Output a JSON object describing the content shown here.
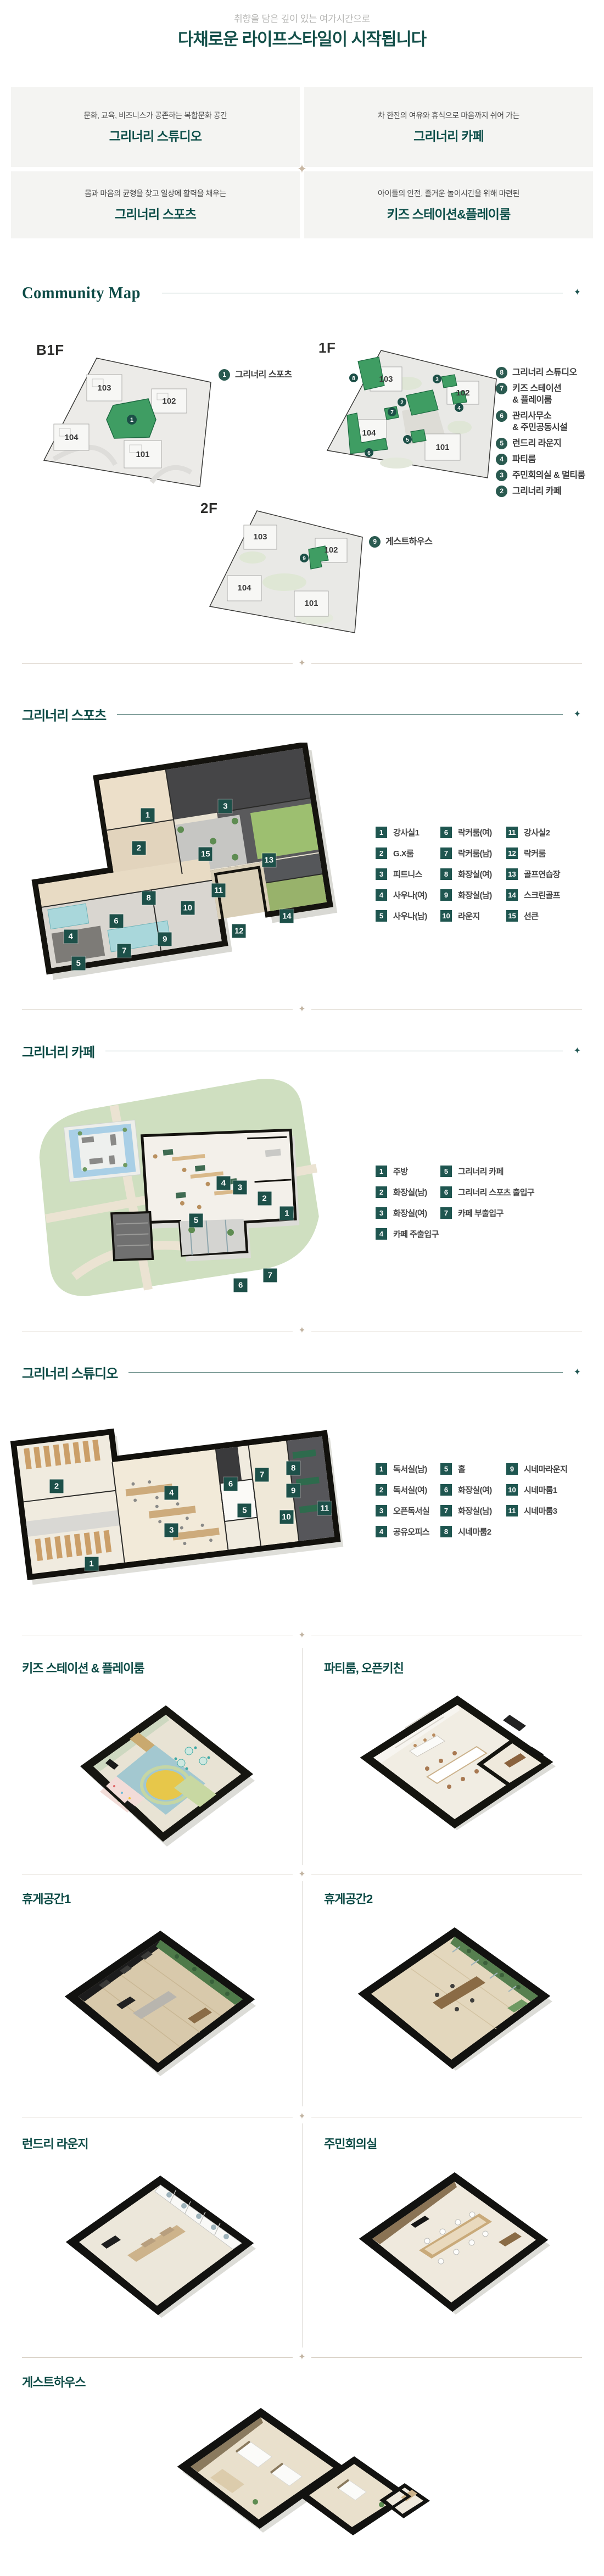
{
  "icons": {
    "diamond": "✦"
  },
  "colors": {
    "accent_teal": "#0d4b46",
    "legend_box": "#1f5650",
    "map_marker": "#2a5a50",
    "highlight_green": "#3f9d63",
    "divider_beige": "#cfc5b8",
    "card_bg": "#f4f4f2"
  },
  "header": {
    "subtitle": "취향을 담은 깊이 있는 여가시간으로",
    "title": "다채로운 라이프스타일이 시작됩니다"
  },
  "feature_cards": [
    {
      "desc": "문화, 교육, 비즈니스가 공존하는 복합문화 공간",
      "title": "그리너리 스튜디오"
    },
    {
      "desc": "차 한잔의 여유와 휴식으로 마음까지 쉬어 가는",
      "title": "그리너리 카페"
    },
    {
      "desc": "몸과 마음의 균형을 찾고 일상에 활력을 채우는",
      "title": "그리너리 스포츠"
    },
    {
      "desc": "아이들의 안전, 즐거운 놀이시간을 위해 마련된",
      "title": "키즈 스테이션&플레이룸"
    }
  ],
  "community_map": {
    "title": "Community Map",
    "floors": [
      {
        "label": "B1F",
        "buildings": [
          "103",
          "102",
          "104",
          "101"
        ],
        "legend": [
          {
            "num": "1",
            "label": "그리너리 스포츠"
          }
        ]
      },
      {
        "label": "1F",
        "buildings": [
          "103",
          "102",
          "104",
          "101"
        ],
        "legend": [
          {
            "num": "8",
            "label": "그리너리 스튜디오"
          },
          {
            "num": "7",
            "label": "키즈 스테이션\n& 플레이룸"
          },
          {
            "num": "6",
            "label": "관리사무소\n& 주민공동시설"
          },
          {
            "num": "5",
            "label": "런드리 라운지"
          },
          {
            "num": "4",
            "label": "파티룸"
          },
          {
            "num": "3",
            "label": "주민회의실 & 멀티룸"
          },
          {
            "num": "2",
            "label": "그리너리 카페"
          }
        ]
      },
      {
        "label": "2F",
        "buildings": [
          "103",
          "102",
          "104",
          "101"
        ],
        "legend": [
          {
            "num": "9",
            "label": "게스트하우스"
          }
        ]
      }
    ]
  },
  "sports": {
    "title": "그리너리 스포츠",
    "legend_cols": [
      [
        {
          "num": "1",
          "label": "강사실1"
        },
        {
          "num": "2",
          "label": "G.X룸"
        },
        {
          "num": "3",
          "label": "피트니스"
        },
        {
          "num": "4",
          "label": "사우나(여)"
        },
        {
          "num": "5",
          "label": "사우나(남)"
        }
      ],
      [
        {
          "num": "6",
          "label": "락커룸(여)"
        },
        {
          "num": "7",
          "label": "락커룸(남)"
        },
        {
          "num": "8",
          "label": "화장실(여)"
        },
        {
          "num": "9",
          "label": "화장실(남)"
        },
        {
          "num": "10",
          "label": "라운지"
        }
      ],
      [
        {
          "num": "11",
          "label": "강사실2"
        },
        {
          "num": "12",
          "label": "락커룸"
        },
        {
          "num": "13",
          "label": "골프연습장"
        },
        {
          "num": "14",
          "label": "스크린골프"
        },
        {
          "num": "15",
          "label": "선큰"
        }
      ]
    ],
    "tags": [
      {
        "n": "1",
        "x": 40.7,
        "y": 30.5
      },
      {
        "n": "2",
        "x": 38,
        "y": 44.5
      },
      {
        "n": "3",
        "x": 64.6,
        "y": 26.9
      },
      {
        "n": "4",
        "x": 17,
        "y": 81.7
      },
      {
        "n": "5",
        "x": 19.4,
        "y": 93
      },
      {
        "n": "6",
        "x": 31,
        "y": 75.3
      },
      {
        "n": "7",
        "x": 33.5,
        "y": 87.7
      },
      {
        "n": "8",
        "x": 41,
        "y": 65.4
      },
      {
        "n": "9",
        "x": 46,
        "y": 82.8
      },
      {
        "n": "10",
        "x": 53,
        "y": 69.6
      },
      {
        "n": "11",
        "x": 62.5,
        "y": 62.3
      },
      {
        "n": "12",
        "x": 68.8,
        "y": 79.3
      },
      {
        "n": "13",
        "x": 78,
        "y": 49.5
      },
      {
        "n": "14",
        "x": 83.5,
        "y": 73.2
      },
      {
        "n": "15",
        "x": 58.5,
        "y": 46.9
      }
    ]
  },
  "cafe": {
    "title": "그리너리 카페",
    "legend_cols": [
      [
        {
          "num": "1",
          "label": "주방"
        },
        {
          "num": "2",
          "label": "화장실(남)"
        },
        {
          "num": "3",
          "label": "화장실(여)"
        },
        {
          "num": "4",
          "label": "카페 주출입구"
        }
      ],
      [
        {
          "num": "5",
          "label": "그리너리 카페"
        },
        {
          "num": "6",
          "label": "그리너리 스포츠 출입구"
        },
        {
          "num": "7",
          "label": "카페 부출입구"
        }
      ]
    ],
    "tags": [
      {
        "n": "1",
        "x": 83.8,
        "y": 62.4
      },
      {
        "n": "2",
        "x": 77,
        "y": 56
      },
      {
        "n": "3",
        "x": 69.6,
        "y": 51.5
      },
      {
        "n": "4",
        "x": 64.6,
        "y": 49.6
      },
      {
        "n": "5",
        "x": 56.3,
        "y": 65.4
      },
      {
        "n": "6",
        "x": 69.8,
        "y": 93
      },
      {
        "n": "7",
        "x": 78.7,
        "y": 88.9
      }
    ]
  },
  "studio": {
    "title": "그리너리 스튜디오",
    "legend_cols": [
      [
        {
          "num": "1",
          "label": "독서실(남)"
        },
        {
          "num": "2",
          "label": "독서실(여)"
        },
        {
          "num": "3",
          "label": "오픈독서실"
        },
        {
          "num": "4",
          "label": "공유오피스"
        }
      ],
      [
        {
          "num": "5",
          "label": "홀"
        },
        {
          "num": "6",
          "label": "화장실(여)"
        },
        {
          "num": "7",
          "label": "화장실(남)"
        },
        {
          "num": "8",
          "label": "시네마룸2"
        }
      ],
      [
        {
          "num": "9",
          "label": "시네마라운지"
        },
        {
          "num": "10",
          "label": "시네마룸1"
        },
        {
          "num": "11",
          "label": "시네마룸3"
        }
      ]
    ],
    "tags": [
      {
        "n": "1",
        "x": 25,
        "y": 76
      },
      {
        "n": "2",
        "x": 15,
        "y": 41
      },
      {
        "n": "3",
        "x": 48,
        "y": 61
      },
      {
        "n": "4",
        "x": 48,
        "y": 44
      },
      {
        "n": "5",
        "x": 69,
        "y": 52
      },
      {
        "n": "6",
        "x": 65,
        "y": 40
      },
      {
        "n": "7",
        "x": 74,
        "y": 36
      },
      {
        "n": "8",
        "x": 83,
        "y": 33
      },
      {
        "n": "9",
        "x": 83,
        "y": 43
      },
      {
        "n": "10",
        "x": 81,
        "y": 55
      },
      {
        "n": "11",
        "x": 92,
        "y": 51
      }
    ]
  },
  "rooms": {
    "kids": {
      "title": "키즈 스테이션 & 플레이룸"
    },
    "party": {
      "title": "파티룸, 오픈키친"
    },
    "rest1": {
      "title": "휴게공간1"
    },
    "rest2": {
      "title": "휴게공간2"
    },
    "laundry": {
      "title": "런드리 라운지"
    },
    "meeting": {
      "title": "주민회의실"
    },
    "guest": {
      "title": "게스트하우스"
    }
  }
}
